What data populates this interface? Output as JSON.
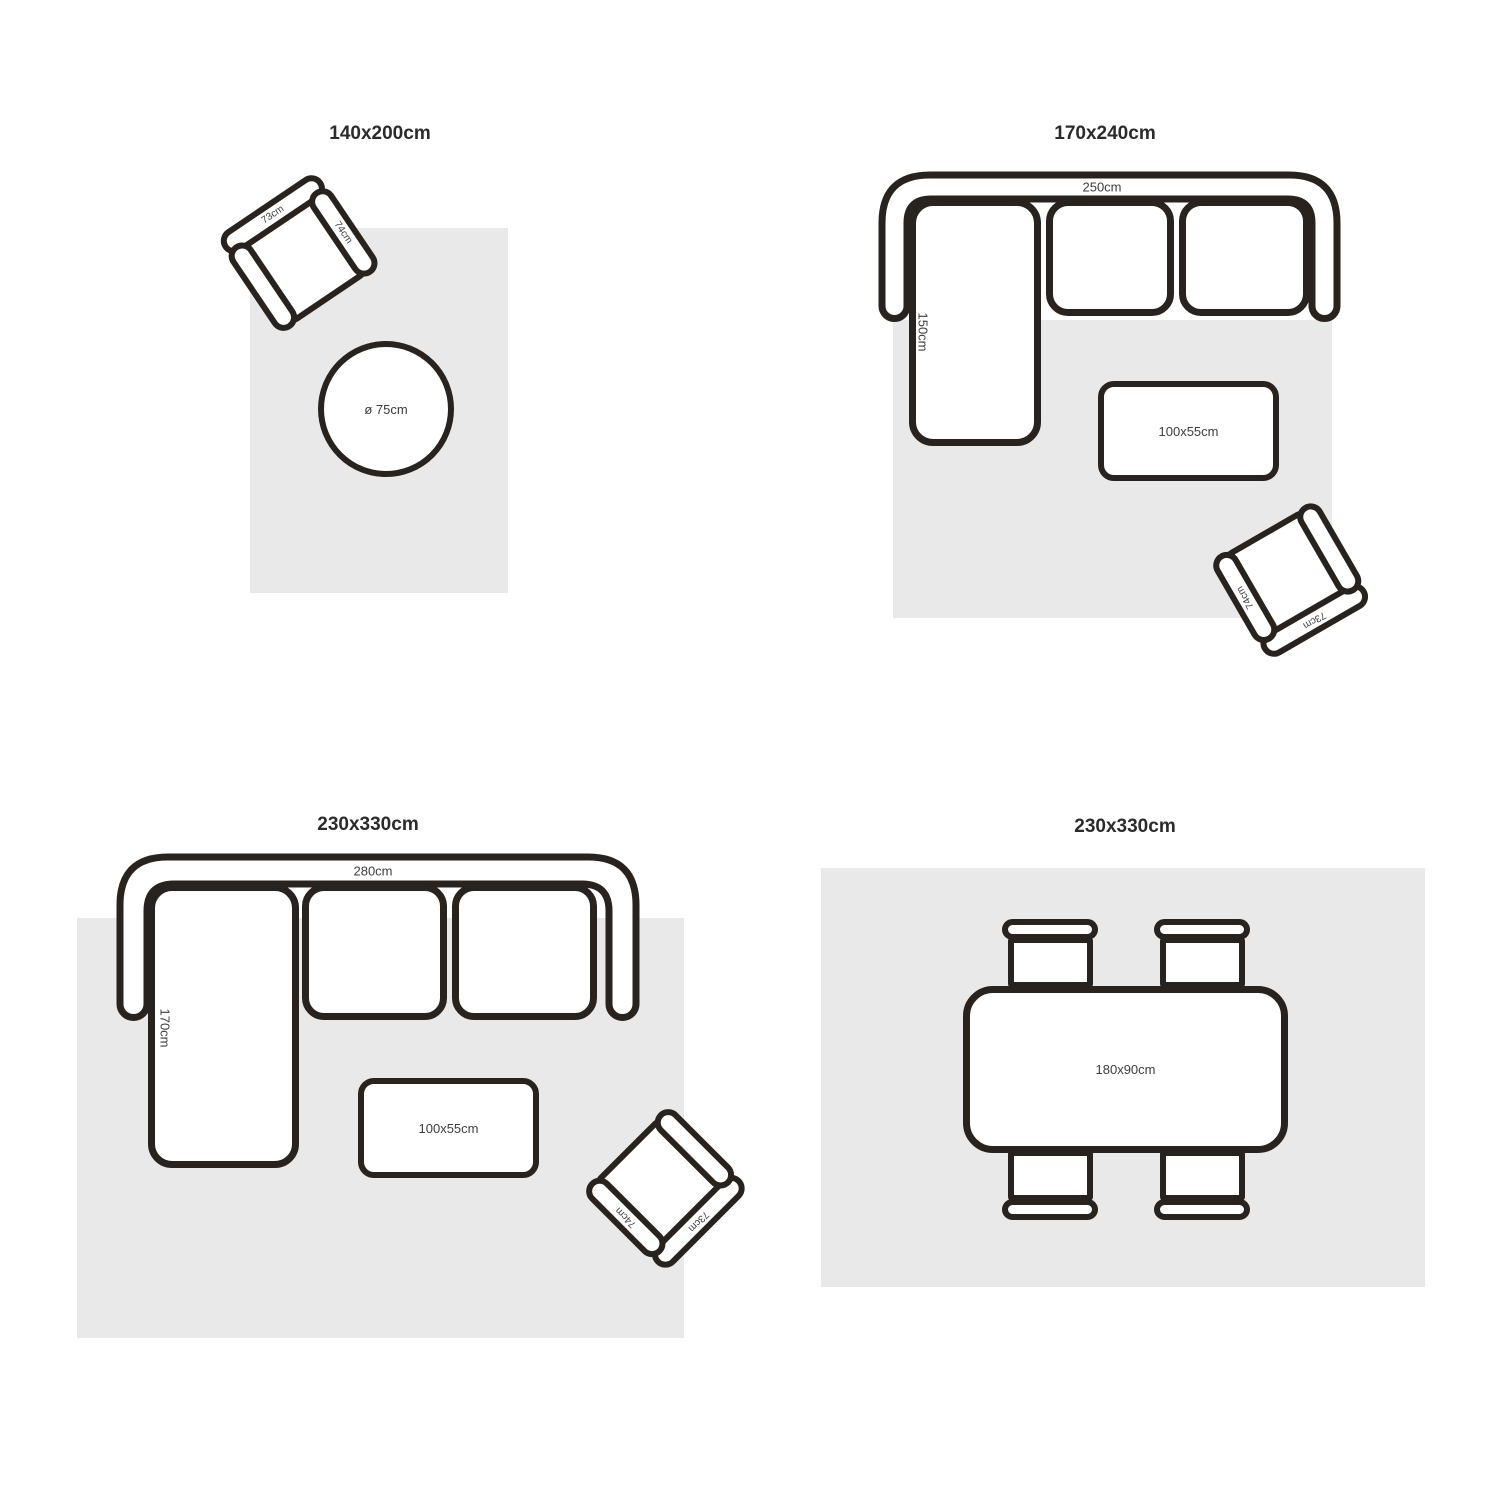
{
  "colors": {
    "stroke": "#29231f",
    "rug": "#e9e9e9",
    "title": "#2b2b2b",
    "label": "#3d3d3d"
  },
  "panels": [
    {
      "title": "140x200cm",
      "round_table_label": "ø 75cm",
      "chair": {
        "back": "73cm",
        "arm": "74cm"
      }
    },
    {
      "title": "170x240cm",
      "sofa_width": "250cm",
      "chaise_depth": "150cm",
      "coffee_table_label": "100x55cm",
      "chair": {
        "back": "73cm",
        "arm": "74cm"
      }
    },
    {
      "title": "230x330cm",
      "sofa_width": "280cm",
      "chaise_depth": "170cm",
      "coffee_table_label": "100x55cm",
      "chair": {
        "back": "73cm",
        "arm": "74cm"
      }
    },
    {
      "title": "230x330cm",
      "dining_table_label": "180x90cm"
    }
  ]
}
